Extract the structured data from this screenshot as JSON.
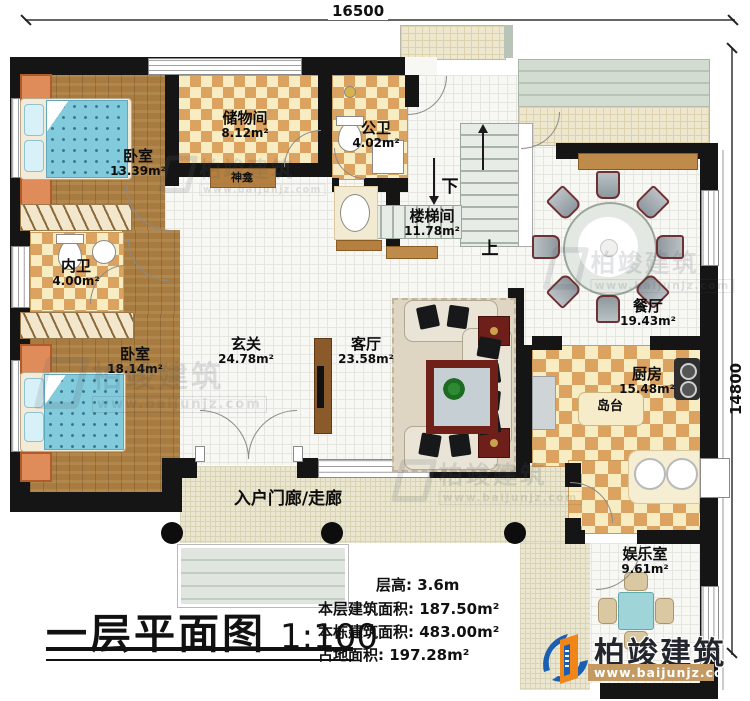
{
  "dimensions": {
    "top": "16500",
    "right": "14800"
  },
  "rooms": {
    "bedroom1": {
      "name": "卧室",
      "area": "13.39m²"
    },
    "storage": {
      "name": "储物间",
      "area": "8.12m²"
    },
    "public_bath": {
      "name": "公卫",
      "area": "4.02m²"
    },
    "stair_hall": {
      "name": "楼梯间",
      "area": "11.78m²"
    },
    "dining": {
      "name": "餐厅",
      "area": "19.43m²"
    },
    "inner_bath": {
      "name": "内卫",
      "area": "4.00m²"
    },
    "bedroom2": {
      "name": "卧室",
      "area": "18.14m²"
    },
    "foyer": {
      "name": "玄关",
      "area": "24.78m²"
    },
    "living": {
      "name": "客厅",
      "area": "23.58m²"
    },
    "kitchen": {
      "name": "厨房",
      "area": "15.48m²"
    },
    "entertainment": {
      "name": "娱乐室",
      "area": "9.61m²"
    },
    "porch": {
      "name": "入户门廊/走廊"
    }
  },
  "features": {
    "shrine": "神龛",
    "island": "岛台",
    "stairs_down": "下",
    "stairs_up": "上"
  },
  "title_block": {
    "plan_title": "一层平面图",
    "scale": "1:100",
    "stats": [
      {
        "label": "层高:",
        "value": "3.6m"
      },
      {
        "label": "本层建筑面积:",
        "value": "187.50m²"
      },
      {
        "label": "本栋建筑面积:",
        "value": "483.00m²"
      },
      {
        "label": "占地面积:",
        "value": "197.28m²"
      }
    ]
  },
  "branding": {
    "company": "柏竣建筑",
    "website": "www.baijunjz.com"
  },
  "watermark": {
    "company": "柏竣建筑",
    "website": "www.baijunjz.com"
  },
  "colors": {
    "wall": "#151515",
    "wood_floor": "#a87c40",
    "tile_orange": "#dca25f",
    "tile_cream": "#f8ecc2",
    "white_tile": "#f7f7f4",
    "porch_tile": "#eae6d0",
    "deck": "#ccd6cb",
    "bed": "#7ec8da",
    "brand_blue": "#1b5fb4",
    "brand_orange": "#f08519",
    "logo_band": "#c49a62",
    "accent_red": "#6e1f1a"
  }
}
